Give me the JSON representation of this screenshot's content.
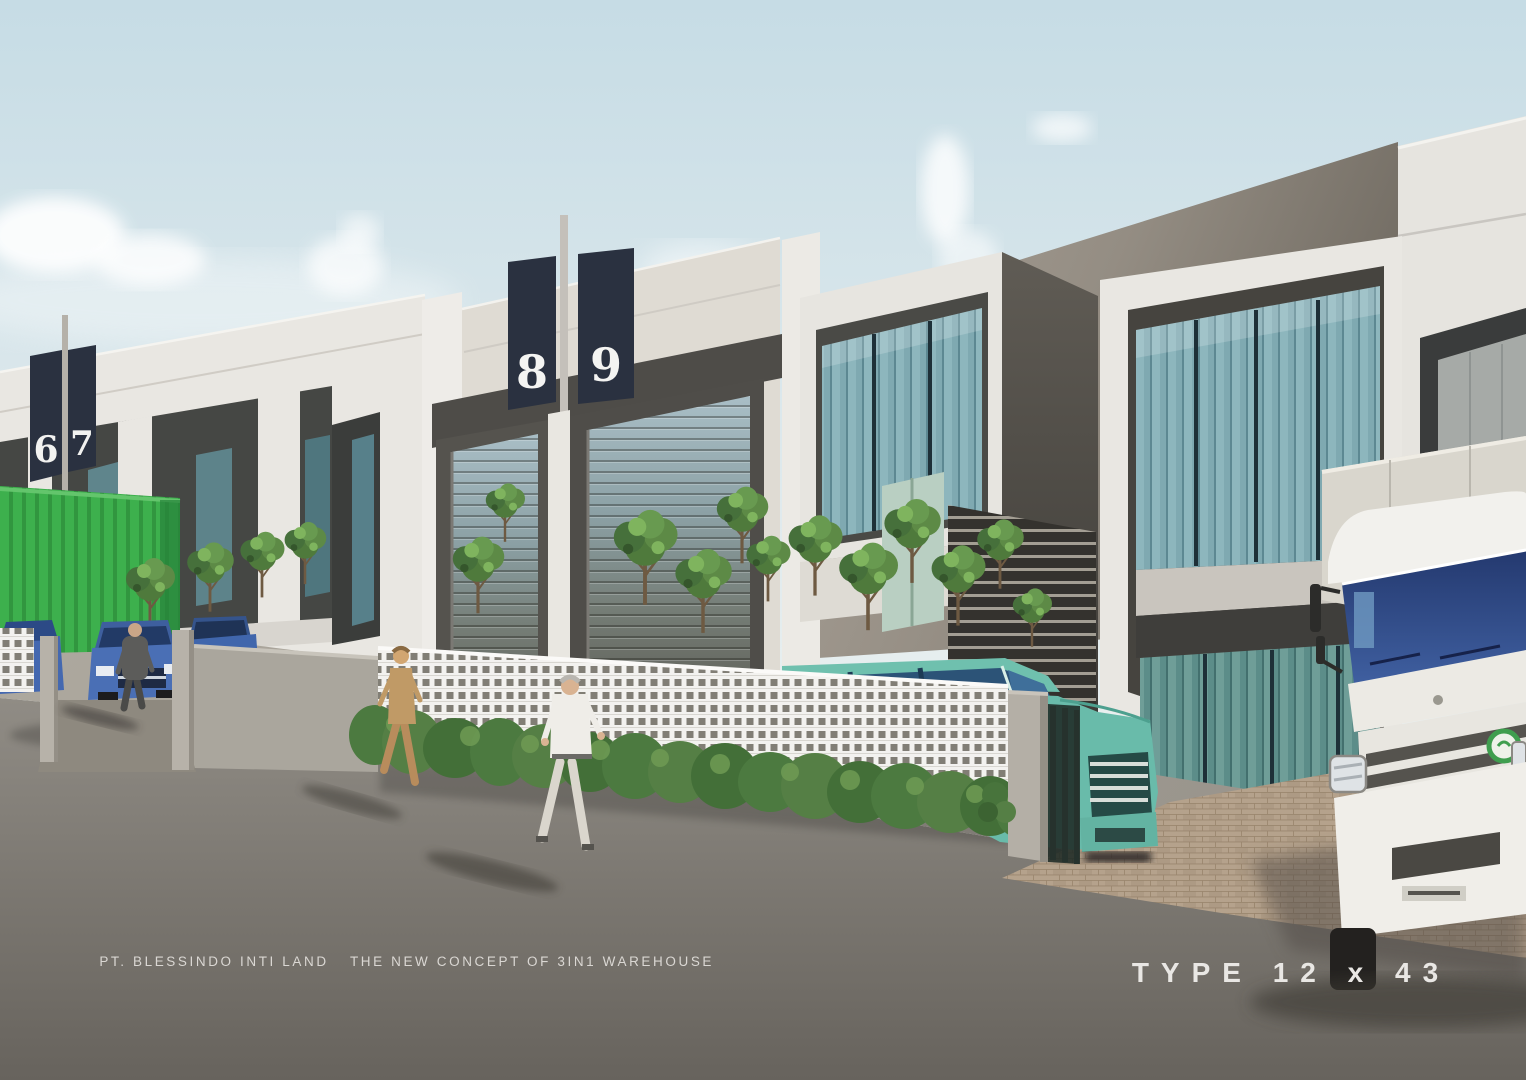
{
  "branding": {
    "company": "PT. BLESSINDO INTI LAND",
    "tagline": "THE NEW CONCEPT OF 3IN1 WAREHOUSE",
    "type_label": "TYPE 12 x 43"
  },
  "unit_signs": [
    "6",
    "7",
    "8",
    "9"
  ],
  "colors": {
    "sky_top": "#c6dce5",
    "sky_horizon": "#eaf0f0",
    "facade_white": "#e9e7e2",
    "parapet_beige": "#ddd8d0",
    "wall_taupe": "#aba399",
    "wall_taupe_shadow": "#716b62",
    "recess_dark": "#4e4c48",
    "sign_navy": "#2a3140",
    "glass_teal": "#7fa9b1",
    "mullion_dark": "#1e3038",
    "shutter_light": "#a9bec6",
    "shutter_dark": "#57544c",
    "container_green": "#3cb14c",
    "car_blue": "#4a6fb5",
    "mpv_teal": "#69bbaa",
    "truck_white": "#f2f1ed",
    "windshield_blue": "#2e4382",
    "truck_logo_green": "#3f9e4f",
    "lattice_white": "#f3f2ef",
    "hedge_green": "#4c7a40",
    "tree_green": "#5d8746",
    "road_asphalt": "#7d7973",
    "apron_concrete": "#a9a49b",
    "brick_paving": "#b5a28c",
    "text_white": "#e8e6e3"
  }
}
